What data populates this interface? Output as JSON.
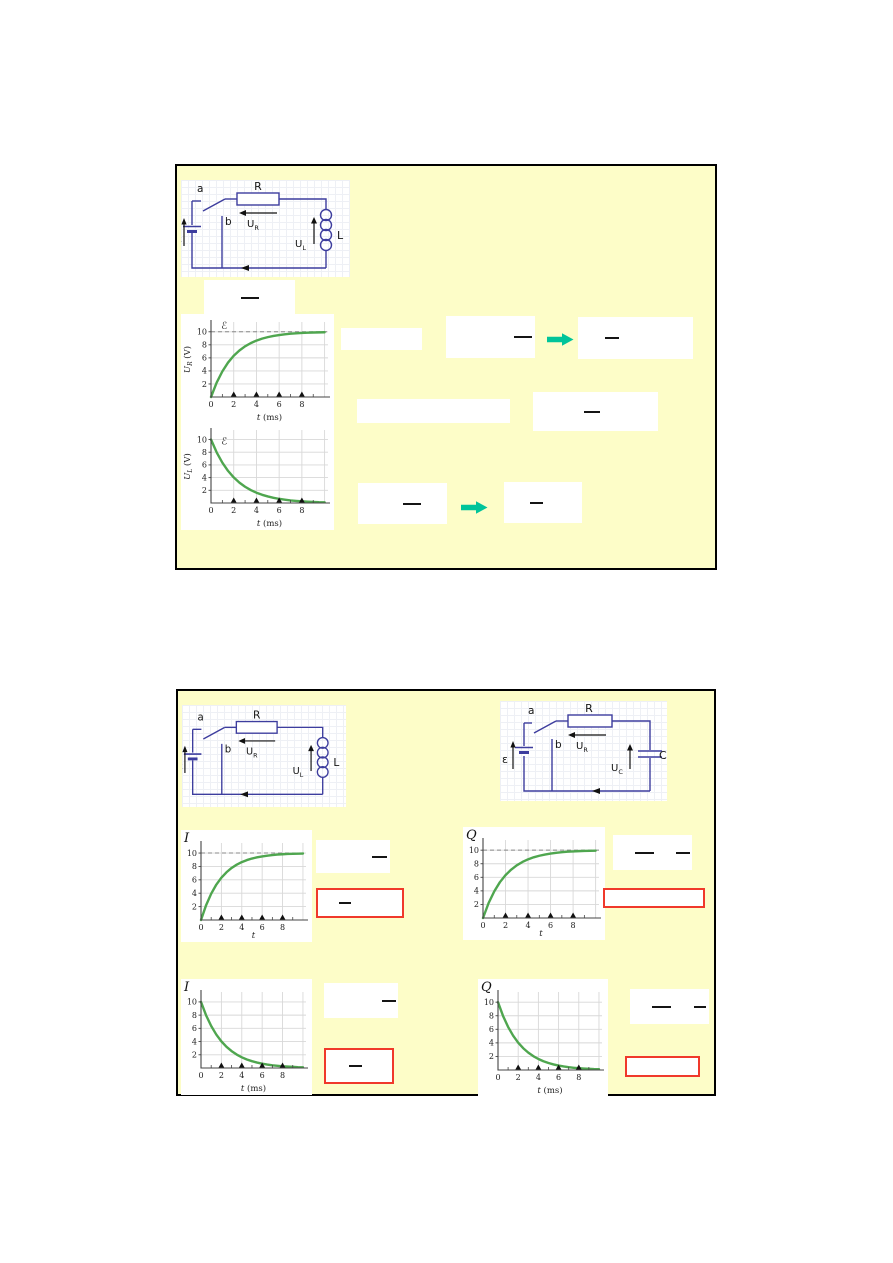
{
  "colors": {
    "slide_bg": "#fdfdc8",
    "slide_border": "#000000",
    "wire_blue": "#3d3d9e",
    "curve_green": "#4fa64f",
    "arrow_teal": "#00c49a",
    "red_box_border": "#f0392b",
    "grid_gray": "#d8d8d8",
    "dashed_gray": "#888888"
  },
  "circuits": {
    "rl": {
      "switch_a": "a",
      "switch_b": "b",
      "resistor": "R",
      "inductor": "L",
      "u_r_main": "U",
      "u_r_sub": "R",
      "u_l_main": "U",
      "u_l_sub": "L",
      "emf": "ε"
    },
    "rc": {
      "switch_a": "a",
      "switch_b": "b",
      "resistor": "R",
      "capacitor": "C",
      "u_r_main": "U",
      "u_r_sub": "R",
      "u_c_main": "U",
      "u_c_sub": "C",
      "emf": "ε"
    }
  },
  "chart_data": [
    {
      "name": "UR-vs-t-rise",
      "type": "line",
      "ylabel": "U_R (V)",
      "xlabel": "t (ms)",
      "corner_label": "",
      "script_label": "ℰ",
      "script_pos": "top",
      "asymptote_y": 10,
      "xticks": [
        0,
        2,
        4,
        6,
        8
      ],
      "yticks": [
        2,
        4,
        6,
        8,
        10
      ],
      "marker_x": [
        2,
        4,
        6,
        8
      ],
      "xlim": [
        0,
        10
      ],
      "ylim": [
        0,
        11.5
      ],
      "x": [
        0,
        0.5,
        1,
        1.5,
        2,
        2.5,
        3,
        3.5,
        4,
        4.5,
        5,
        5.5,
        6,
        6.5,
        7,
        7.5,
        8,
        8.5,
        9,
        9.5,
        10
      ],
      "y": [
        0,
        2.21,
        3.93,
        5.28,
        6.32,
        7.13,
        7.77,
        8.26,
        8.65,
        8.95,
        9.18,
        9.36,
        9.5,
        9.61,
        9.7,
        9.77,
        9.82,
        9.86,
        9.89,
        9.91,
        9.93
      ]
    },
    {
      "name": "UL-vs-t-decay",
      "type": "line",
      "ylabel": "U_L (V)",
      "xlabel": "t (ms)",
      "corner_label": "",
      "script_label": "ℰ",
      "script_pos": "start",
      "asymptote_y": null,
      "xticks": [
        0,
        2,
        4,
        6,
        8
      ],
      "yticks": [
        2,
        4,
        6,
        8,
        10
      ],
      "marker_x": [
        2,
        4,
        6,
        8
      ],
      "xlim": [
        0,
        10
      ],
      "ylim": [
        0,
        11.5
      ],
      "x": [
        0,
        0.5,
        1,
        1.5,
        2,
        2.5,
        3,
        3.5,
        4,
        4.5,
        5,
        5.5,
        6,
        6.5,
        7,
        7.5,
        8,
        8.5,
        9,
        9.5,
        10
      ],
      "y": [
        10,
        7.97,
        6.35,
        5.06,
        4.03,
        3.21,
        2.56,
        2.04,
        1.62,
        1.29,
        1.03,
        0.82,
        0.65,
        0.52,
        0.41,
        0.33,
        0.26,
        0.21,
        0.17,
        0.13,
        0.11
      ]
    },
    {
      "name": "I-vs-t-rise",
      "type": "line",
      "ylabel": "",
      "xlabel": "t",
      "corner_label": "I",
      "script_label": "",
      "script_pos": "",
      "asymptote_y": 10,
      "xticks": [
        0,
        2,
        4,
        6,
        8
      ],
      "yticks": [
        2,
        4,
        6,
        8,
        10
      ],
      "marker_x": [
        2,
        4,
        6,
        8
      ],
      "xlim": [
        0,
        10
      ],
      "ylim": [
        0,
        11.5
      ],
      "x": [
        0,
        0.5,
        1,
        1.5,
        2,
        2.5,
        3,
        3.5,
        4,
        4.5,
        5,
        5.5,
        6,
        6.5,
        7,
        7.5,
        8,
        8.5,
        9,
        9.5,
        10
      ],
      "y": [
        0,
        2.21,
        3.93,
        5.28,
        6.32,
        7.13,
        7.77,
        8.26,
        8.65,
        8.95,
        9.18,
        9.36,
        9.5,
        9.61,
        9.7,
        9.77,
        9.82,
        9.86,
        9.89,
        9.91,
        9.93
      ]
    },
    {
      "name": "Q-vs-t-rise",
      "type": "line",
      "ylabel": "",
      "xlabel": "t",
      "corner_label": "Q",
      "script_label": "",
      "script_pos": "",
      "asymptote_y": 10,
      "xticks": [
        0,
        2,
        4,
        6,
        8
      ],
      "yticks": [
        2,
        4,
        6,
        8,
        10
      ],
      "marker_x": [
        2,
        4,
        6,
        8
      ],
      "xlim": [
        0,
        10
      ],
      "ylim": [
        0,
        11.5
      ],
      "x": [
        0,
        0.5,
        1,
        1.5,
        2,
        2.5,
        3,
        3.5,
        4,
        4.5,
        5,
        5.5,
        6,
        6.5,
        7,
        7.5,
        8,
        8.5,
        9,
        9.5,
        10
      ],
      "y": [
        0,
        2.21,
        3.93,
        5.28,
        6.32,
        7.13,
        7.77,
        8.26,
        8.65,
        8.95,
        9.18,
        9.36,
        9.5,
        9.61,
        9.7,
        9.77,
        9.82,
        9.86,
        9.89,
        9.91,
        9.93
      ]
    },
    {
      "name": "I-vs-t-decay",
      "type": "line",
      "ylabel": "",
      "xlabel": "t (ms)",
      "corner_label": "I",
      "script_label": "",
      "script_pos": "",
      "asymptote_y": null,
      "xticks": [
        0,
        2,
        4,
        6,
        8
      ],
      "yticks": [
        2,
        4,
        6,
        8,
        10
      ],
      "marker_x": [
        2,
        4,
        6,
        8
      ],
      "xlim": [
        0,
        10
      ],
      "ylim": [
        0,
        11.5
      ],
      "x": [
        0,
        0.5,
        1,
        1.5,
        2,
        2.5,
        3,
        3.5,
        4,
        4.5,
        5,
        5.5,
        6,
        6.5,
        7,
        7.5,
        8,
        8.5,
        9,
        9.5,
        10
      ],
      "y": [
        10,
        7.97,
        6.35,
        5.06,
        4.03,
        3.21,
        2.56,
        2.04,
        1.62,
        1.29,
        1.03,
        0.82,
        0.65,
        0.52,
        0.41,
        0.33,
        0.26,
        0.21,
        0.17,
        0.13,
        0.11
      ]
    },
    {
      "name": "Q-vs-t-decay",
      "type": "line",
      "ylabel": "",
      "xlabel": "t (ms)",
      "corner_label": "Q",
      "script_label": "",
      "script_pos": "",
      "asymptote_y": null,
      "xticks": [
        0,
        2,
        4,
        6,
        8
      ],
      "yticks": [
        2,
        4,
        6,
        8,
        10
      ],
      "marker_x": [
        2,
        4,
        6,
        8
      ],
      "xlim": [
        0,
        10
      ],
      "ylim": [
        0,
        11.5
      ],
      "x": [
        0,
        0.5,
        1,
        1.5,
        2,
        2.5,
        3,
        3.5,
        4,
        4.5,
        5,
        5.5,
        6,
        6.5,
        7,
        7.5,
        8,
        8.5,
        9,
        9.5,
        10
      ],
      "y": [
        10,
        7.97,
        6.35,
        5.06,
        4.03,
        3.21,
        2.56,
        2.04,
        1.62,
        1.29,
        1.03,
        0.82,
        0.65,
        0.52,
        0.41,
        0.33,
        0.26,
        0.21,
        0.17,
        0.13,
        0.11
      ]
    }
  ]
}
